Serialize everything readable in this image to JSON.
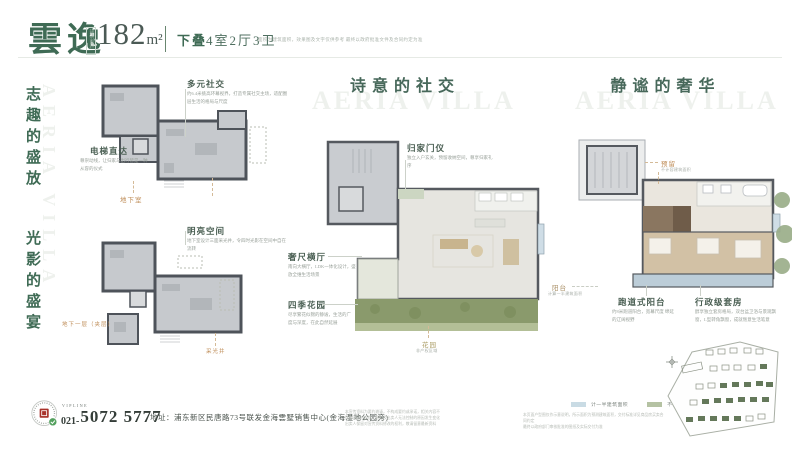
{
  "header": {
    "brand": "雲逸",
    "area_badge": "建筑面积",
    "area_value": "182",
    "area_unit": "m²",
    "type_tag": "下叠",
    "layout": "4室2厅3卫",
    "disclaimer": "面积为建筑面积，效果图及文字仅供参考 最终以政府批准文件及合同约定为准"
  },
  "left_rail": {
    "slogan_top": "志趣的盛放",
    "slogan_bottom": "光影的盛宴",
    "watermark": "AERIA VILLA"
  },
  "plans": {
    "basement": {
      "callouts": [
        {
          "title": "多元社交",
          "desc": "约6.4米挑高环幕视界，打造专属社交主场，适配圈层生活的格局与尺度"
        },
        {
          "title": "电梯直达",
          "desc": "尊崇动线，让归家与出行皆是一种从容的仪式"
        }
      ],
      "floor_label": "地下室"
    },
    "mezzanine": {
      "callouts": [
        {
          "title": "明亮空间",
          "desc": "地下室设计三面采光井，令四时光影在空间中自在流转"
        }
      ],
      "floor_label": "地下一层（夹层）",
      "well_label": "采光井"
    },
    "first_floor": {
      "title": "诗意的社交",
      "watermark": "AERIA VILLA",
      "callouts": [
        {
          "title": "归家门仪",
          "desc": "独立入户玄关，预留收纳空间，尊享归家礼序"
        },
        {
          "title": "奢尺横厅",
          "desc": "南向大横厅，LDK一体化设计，盛放全维生活场景"
        },
        {
          "title": "四季花园",
          "desc": "尽享繁花似锦的静谧，生活的广度与深度，在此自然延展"
        }
      ],
      "garden_label": "花园",
      "garden_note": "非产权区域"
    },
    "second_floor": {
      "title": "静谧的奢华",
      "watermark": "AERIA VILLA",
      "callouts": [
        {
          "title": "预留",
          "desc": "不计容建筑面积"
        },
        {
          "title": "阳台",
          "desc": "计算一半建筑面积"
        },
        {
          "title": "跑道式阳台",
          "desc": "约8米跑道阳台，宽幕尺度 绵延的辽阔视野"
        },
        {
          "title": "行政级套房",
          "desc": "醇享独立套房格局，双台盆卫浴与景观飘窗，L型转角飘窗，成就惬意生活笔意"
        }
      ]
    }
  },
  "footer": {
    "vipline_label": "VIPLINE",
    "phone_prefix": "021-",
    "phone_number": "5072 5777",
    "address": "地址：浦东新区民唐路73号联发金海雲墅销售中心(金海湿地公园旁)",
    "fine_print_1": "本宣传资料为要约邀请，不构成要约或承诺，相关内容不排除因政府规划、规定及出卖人无法控制的原因发生变化",
    "fine_print_2": "出卖人保留对宣传资料修改的权利，敬请留意最新资料",
    "legend": [
      {
        "label": "计一半建筑面积",
        "color": "#c9dbe4"
      },
      {
        "label": "不计建筑面积",
        "color": "#b5c2a3"
      }
    ],
    "legend_note_1": "本页面户型图仅作示意说明，所示面积为预测建筑面积，交付标准详见商品房买卖合同约定",
    "legend_note_2": "最终以政府部门审核批准的图纸及实际交付为准"
  },
  "colors": {
    "brand_green": "#3f6b55",
    "title_green": "#47685a",
    "accent_orange": "#bf8d58",
    "plan_gray": "#c6c9cd",
    "garden_green": "#8a9a6c",
    "balcony_blue": "#bccdd8",
    "legend_blue": "#c9dbe4",
    "legend_green": "#b5c2a3"
  }
}
